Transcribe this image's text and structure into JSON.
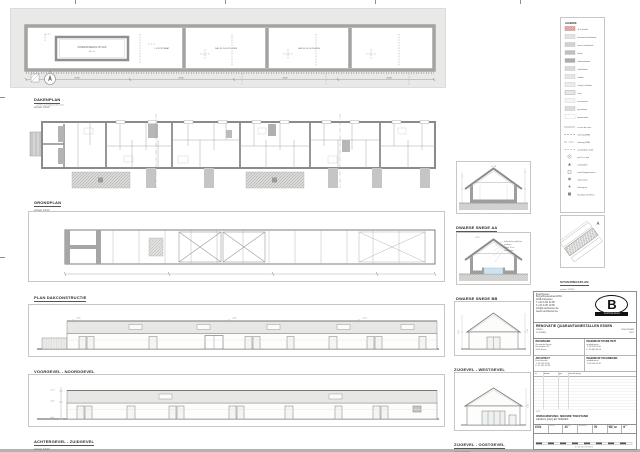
{
  "drawings": {
    "roof_plan": {
      "title": "DAKENPLAN",
      "scale": "schaal: 1/100",
      "skylight_label": "ZONNEPANELEN OP DAK",
      "skylight_sub": "(60 st.)",
      "roof_label_1": "LICHTSTRAAT",
      "roof_label_2": "DAK IN GOLFPLATEN",
      "roof_label_3": "DAK IN GOLFPLATEN",
      "north": "N",
      "dims": [
        "20.80",
        "20.80",
        "20.80",
        "20.80"
      ]
    },
    "ground_plan": {
      "title": "GRONDPLAN",
      "scale": "schaal: 1/100",
      "note": "+0.00 = peil afgewerkte vloer"
    },
    "structure_plan": {
      "title": "PLAN DAKCONSTRUCTIE",
      "scale": "schaal: 1/100"
    },
    "elevation_front": {
      "title": "VOORGEVEL  -  NOORDGEVEL",
      "scale": "schaal: 1/100",
      "levels": [
        "+4.95",
        "+7.10",
        "+4.95"
      ]
    },
    "elevation_rear": {
      "title": "ACHTERGEVEL  -  ZUIDGEVEL",
      "scale": "schaal: 1/100",
      "levels": [
        "+7.10",
        "+4.95",
        "±0.00"
      ]
    },
    "section_a": {
      "title": "DWARSE SNEDE AA",
      "scale": "schaal: 1/50",
      "ridge_level": "+7.10"
    },
    "section_b": {
      "title": "DWARSE SNEDE BB",
      "scale": "schaal: 1/50",
      "ridge_level": "+7.10",
      "notes": [
        "dakbedekking golfplaten",
        "gordingen",
        "isolatie 18 cm",
        "waterbekken"
      ]
    },
    "gable_left": {
      "title": "ZIJGEVEL  -  WESTGEVEL",
      "scale": "schaal: 1/100",
      "levels": [
        "4.95",
        "7.10"
      ]
    },
    "gable_right": {
      "title": "ZIJGEVEL  -  OOSTGEVEL",
      "scale": "schaal: 1/100",
      "levels": [
        "7.10"
      ]
    },
    "situation": {
      "title": "SITUERINGSPLAN",
      "scale": "schaal: 1/2500"
    }
  },
  "legend": {
    "title": "LEGENDE",
    "items": [
      {
        "label": "af te breken"
      },
      {
        "label": "bestaand metselwerk"
      },
      {
        "label": "nieuw metselwerk"
      },
      {
        "label": "beton"
      },
      {
        "label": "kalkzandsteen"
      },
      {
        "label": "cellenbeton"
      },
      {
        "label": "isolatie"
      },
      {
        "label": "chape / dekvloer"
      },
      {
        "label": "hout"
      },
      {
        "label": "natuursteen"
      },
      {
        "label": "gevelsteen"
      },
      {
        "label": "pleisterwerk"
      },
      {
        "label": "as van de muur"
      },
      {
        "label": "riolering RWA"
      },
      {
        "label": "riolering DWA"
      },
      {
        "label": "aanduiding snede"
      },
      {
        "label": "peil t.o.v. pas"
      },
      {
        "label": "rookmelder"
      },
      {
        "label": "verlichtingsarmatuur"
      },
      {
        "label": "stopcontact"
      },
      {
        "label": "afvoerpunt"
      },
      {
        "label": "brandwerend Rf 1h"
      }
    ]
  },
  "titleblock": {
    "firm_lines": [
      "B architecten",
      "Borgerhoutsestraat 22/01",
      "2018 Antwerpen",
      "T +32 3 231 02 85",
      "F +32 3 231 02 86",
      "info@b-architecten.be",
      "www.b-architecten.be"
    ],
    "logo": {
      "letter": "B",
      "name": "architecten"
    },
    "project": {
      "title": "RENOVATIE QUARANTAINESTALLEN ESSEN",
      "werf_label": "WERF:",
      "werf_value": "2910 ESSEN",
      "dossier_label": "DOSSIER:",
      "dossier_value": "1627"
    },
    "parties": [
      {
        "role": "BOUWHEER",
        "lines": [
          "Gemeente Essen",
          "Heuvelplein 23",
          "2910 Essen"
        ]
      },
      {
        "role": "INGENIEUR STABILITEIT",
        "lines": [
          "studiebureau",
          "T: 03 000 00 00",
          "F: 03 000 00 00"
        ]
      },
      {
        "role": "ARCHITECT",
        "lines": [
          "B architecten",
          "T: 03 231 02 85",
          "F: 03 231 02 86"
        ]
      },
      {
        "role": "INGENIEUR TECHNIEKEN",
        "lines": [
          "studiebureau",
          "T: 03 000 00 00"
        ]
      }
    ],
    "revisions_headers": [
      "nr.",
      "datum",
      "get.",
      "omschrijving"
    ],
    "lot": {
      "label": "LOT",
      "description": "OMSCHRIJVING:  NIEUWE TOESTAND",
      "content": "GEVELS (plan) EN SNEDES"
    },
    "info_strip": [
      {
        "label": "schaal",
        "value": "1/100"
      },
      {
        "label": "datum",
        "value": ""
      },
      {
        "label": "formaat",
        "value": "A0"
      },
      {
        "label": "getekend",
        "value": ""
      },
      {
        "label": "fase",
        "value": "UV"
      },
      {
        "label": "plan nr.",
        "value": "WE_02"
      },
      {
        "label": "index",
        "value": "B"
      }
    ],
    "ruler_numbers": "0   1   2   3   4   5   6   7   8   9   10 m"
  }
}
